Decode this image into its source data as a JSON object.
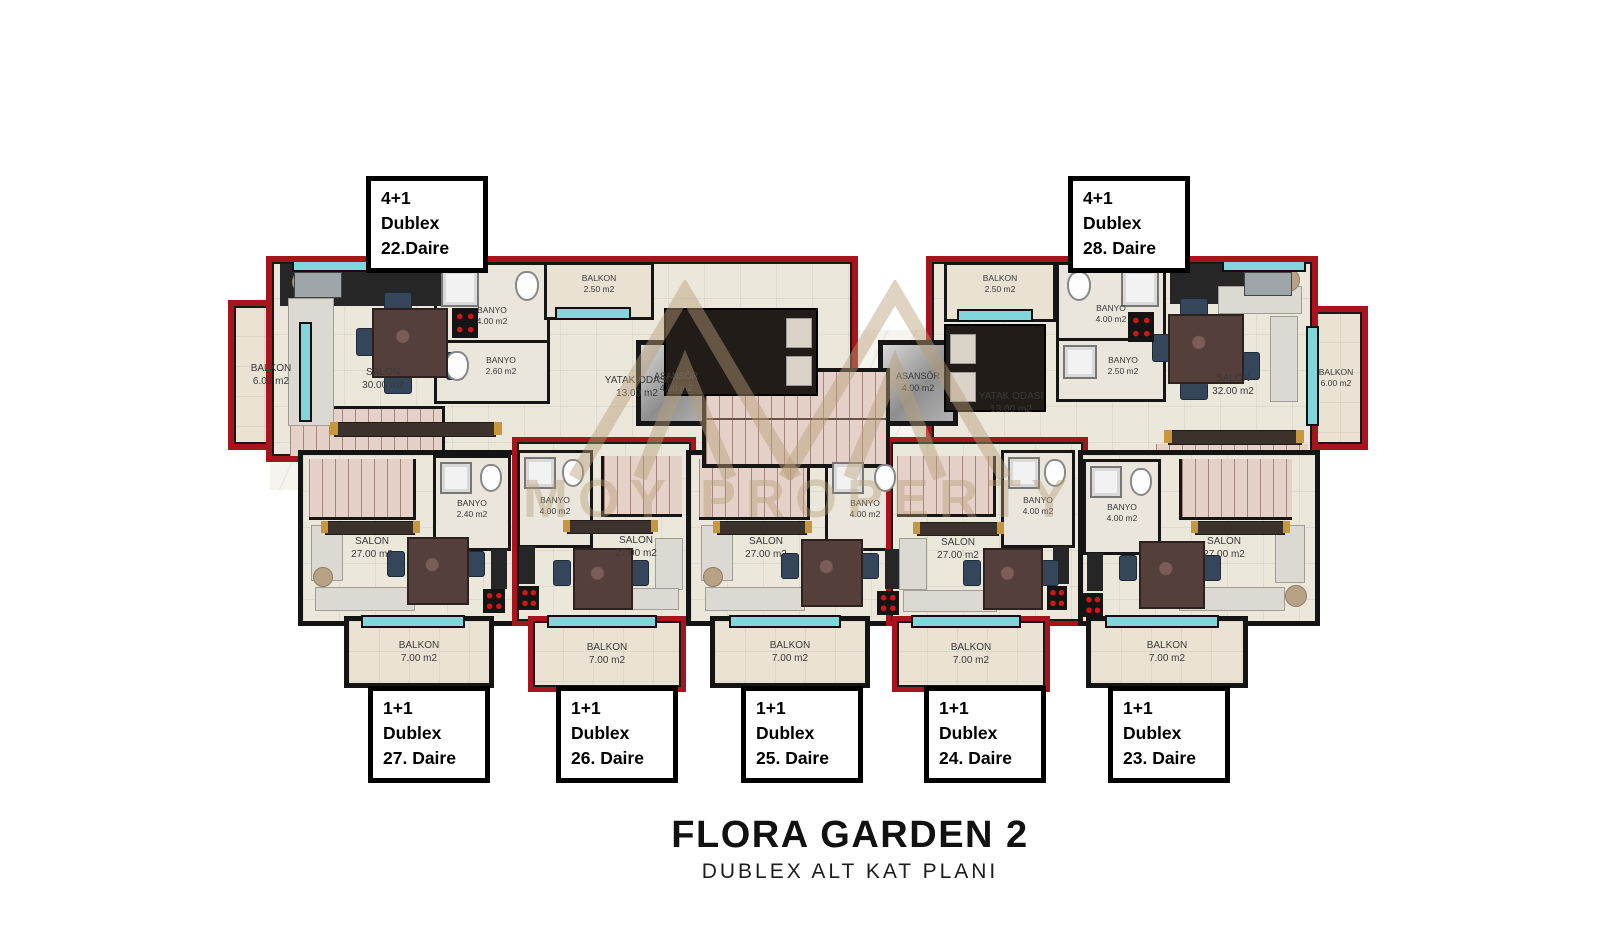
{
  "title": {
    "main": "FLORA GARDEN 2",
    "subtitle": "DUBLEX ALT KAT PLANI"
  },
  "watermark": {
    "text": "MOY PROPERTY"
  },
  "colors": {
    "red": "#a8141e",
    "teal": "#82d5da",
    "rose": "#e6d1c8",
    "floor": "#ece7db",
    "tan": "#b79b70",
    "wall": "#141414"
  },
  "core": {
    "elevators": [
      {
        "name": "ASANSÖR",
        "area": "4.00 m2"
      },
      {
        "name": "ASANSÖR",
        "area": "4.00 m2"
      }
    ]
  },
  "units": {
    "u22": {
      "tag": [
        "4+1",
        "Dublex",
        "22.Daire"
      ],
      "rooms": {
        "balkon_side": {
          "name": "BALKON",
          "area": "6.00 m2"
        },
        "salon": {
          "name": "SALON",
          "area": "30.00 m2"
        },
        "banyo_big": {
          "name": "BANYO",
          "area": "4.00 m2"
        },
        "banyo_small": {
          "name": "BANYO",
          "area": "2.60 m2"
        },
        "balkon_top": {
          "name": "BALKON",
          "area": "2.50 m2"
        },
        "yatak": {
          "name": "YATAK ODASI",
          "area": "13.00 m2"
        }
      }
    },
    "u28": {
      "tag": [
        "4+1",
        "Dublex",
        "28. Daire"
      ],
      "rooms": {
        "balkon_top": {
          "name": "BALKON",
          "area": "2.50 m2"
        },
        "banyo_big": {
          "name": "BANYO",
          "area": "4.00 m2"
        },
        "banyo_small": {
          "name": "BANYO",
          "area": "2.50 m2"
        },
        "yatak": {
          "name": "YATAK ODASI",
          "area": "13.00 m2"
        },
        "salon": {
          "name": "SALON",
          "area": "32.00 m2"
        },
        "balkon_side": {
          "name": "BALKON",
          "area": "6.00 m2"
        }
      }
    },
    "u27": {
      "tag": [
        "1+1",
        "Dublex",
        "27. Daire"
      ],
      "rooms": {
        "salon": {
          "name": "SALON",
          "area": "27.00 m2"
        },
        "banyo": {
          "name": "BANYO",
          "area": "2.40 m2"
        },
        "balkon": {
          "name": "BALKON",
          "area": "7.00 m2"
        }
      }
    },
    "u26": {
      "tag": [
        "1+1",
        "Dublex",
        "26. Daire"
      ],
      "rooms": {
        "salon": {
          "name": "SALON",
          "area": "27.00 m2"
        },
        "banyo": {
          "name": "BANYO",
          "area": "4.00 m2"
        },
        "balkon": {
          "name": "BALKON",
          "area": "7.00 m2"
        }
      }
    },
    "u25": {
      "tag": [
        "1+1",
        "Dublex",
        "25. Daire"
      ],
      "rooms": {
        "salon": {
          "name": "SALON",
          "area": "27.00 m2"
        },
        "banyo": {
          "name": "BANYO",
          "area": "4.00 m2"
        },
        "balkon": {
          "name": "BALKON",
          "area": "7.00 m2"
        }
      }
    },
    "u24": {
      "tag": [
        "1+1",
        "Dublex",
        "24. Daire"
      ],
      "rooms": {
        "salon": {
          "name": "SALON",
          "area": "27.00 m2"
        },
        "banyo": {
          "name": "BANYO",
          "area": "4.00 m2"
        },
        "balkon": {
          "name": "BALKON",
          "area": "7.00 m2"
        }
      }
    },
    "u23": {
      "tag": [
        "1+1",
        "Dublex",
        "23. Daire"
      ],
      "rooms": {
        "salon": {
          "name": "SALON",
          "area": "27.00 m2"
        },
        "banyo": {
          "name": "BANYO",
          "area": "4.00 m2"
        },
        "balkon": {
          "name": "BALKON",
          "area": "7.00 m2"
        }
      }
    }
  }
}
